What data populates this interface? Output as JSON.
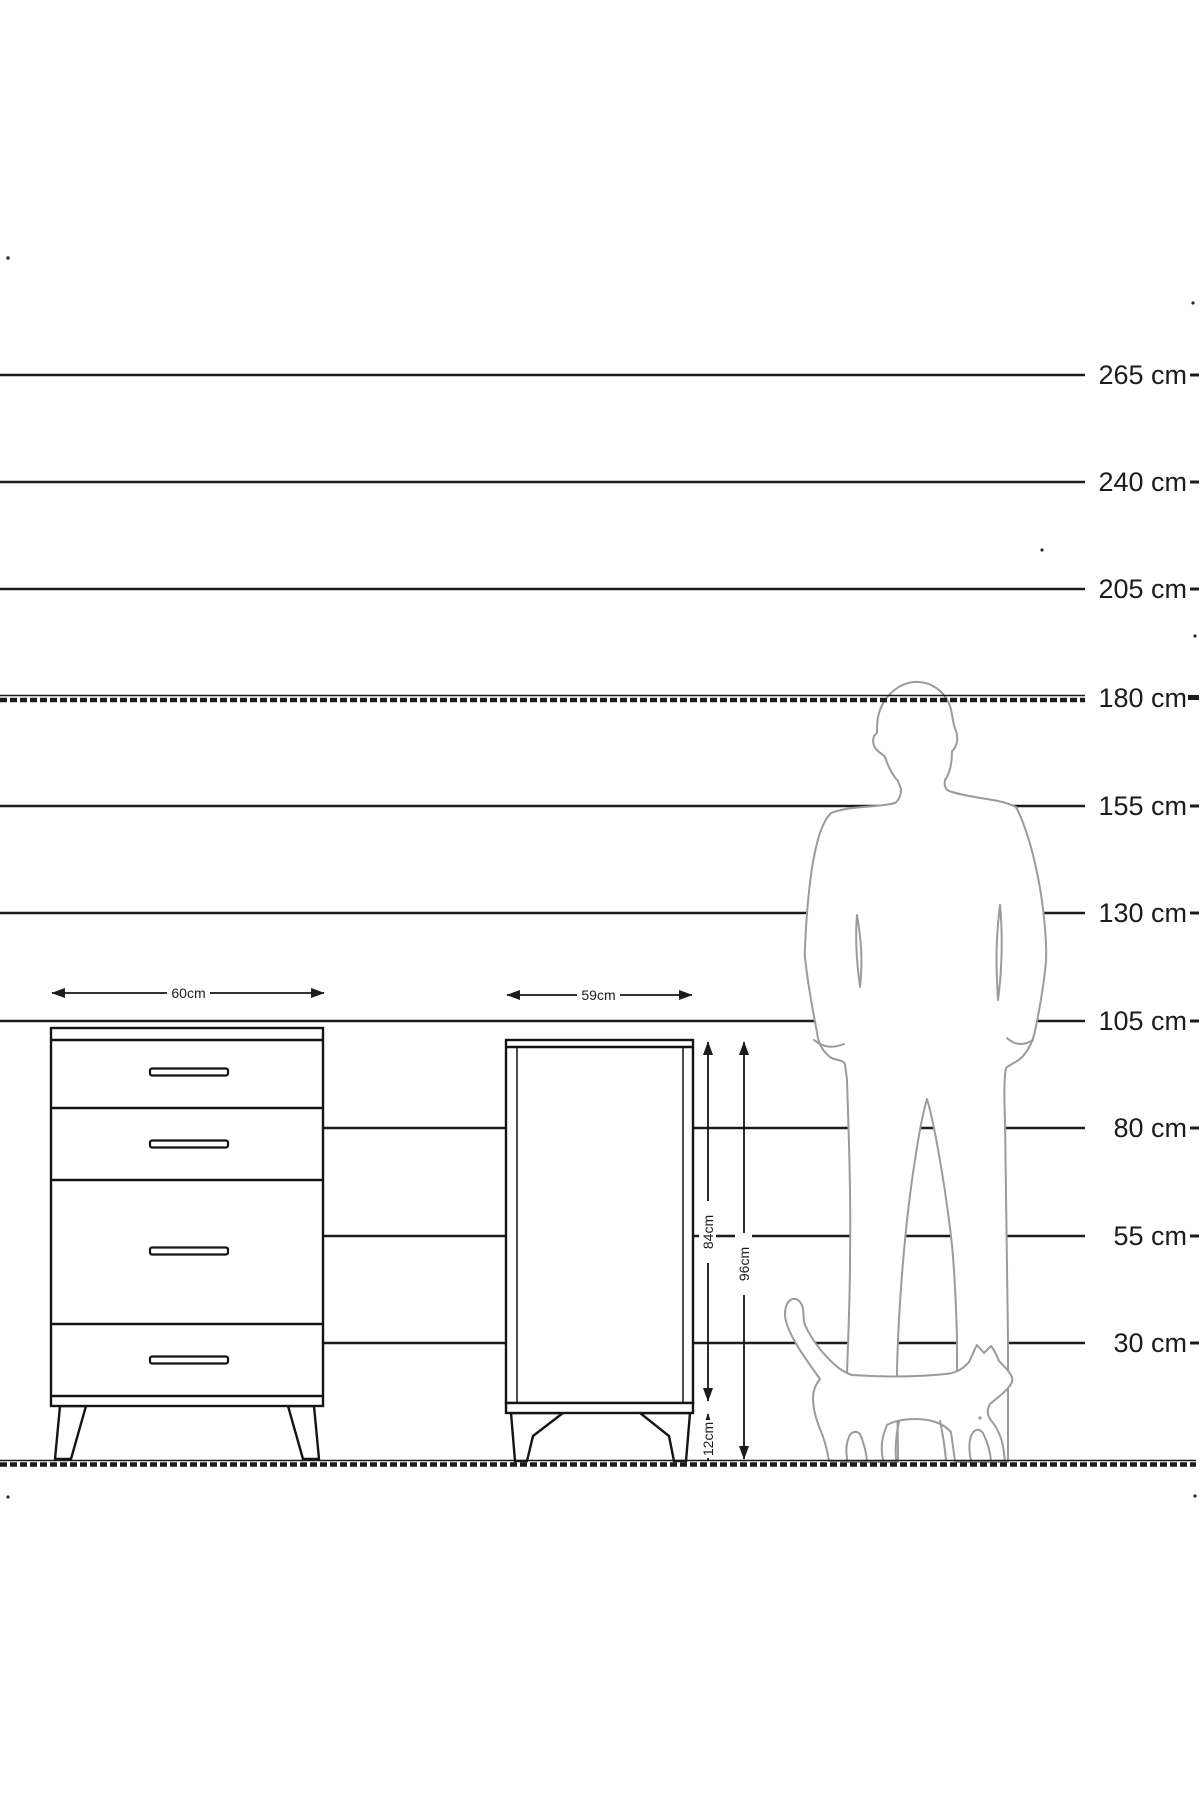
{
  "scale": {
    "unit_suffix": "cm",
    "labels": [
      "265 cm",
      "240 cm",
      "205 cm",
      "180 cm",
      "155 cm",
      "130 cm",
      "105 cm",
      "80 cm",
      "55 cm",
      "30 cm"
    ]
  },
  "furniture": {
    "chest": {
      "width_label": "60cm",
      "drawer_count": 4
    },
    "cabinet": {
      "width_label": "59cm",
      "body_height_label": "84cm",
      "total_height_label": "96cm",
      "leg_height_label": "12cm"
    }
  },
  "silhouettes": {
    "person": "standing-man",
    "cat": "walking-cat"
  },
  "colors": {
    "line": "#1c1c1c",
    "silhouette": "#9b9b9b",
    "background": "#ffffff"
  }
}
